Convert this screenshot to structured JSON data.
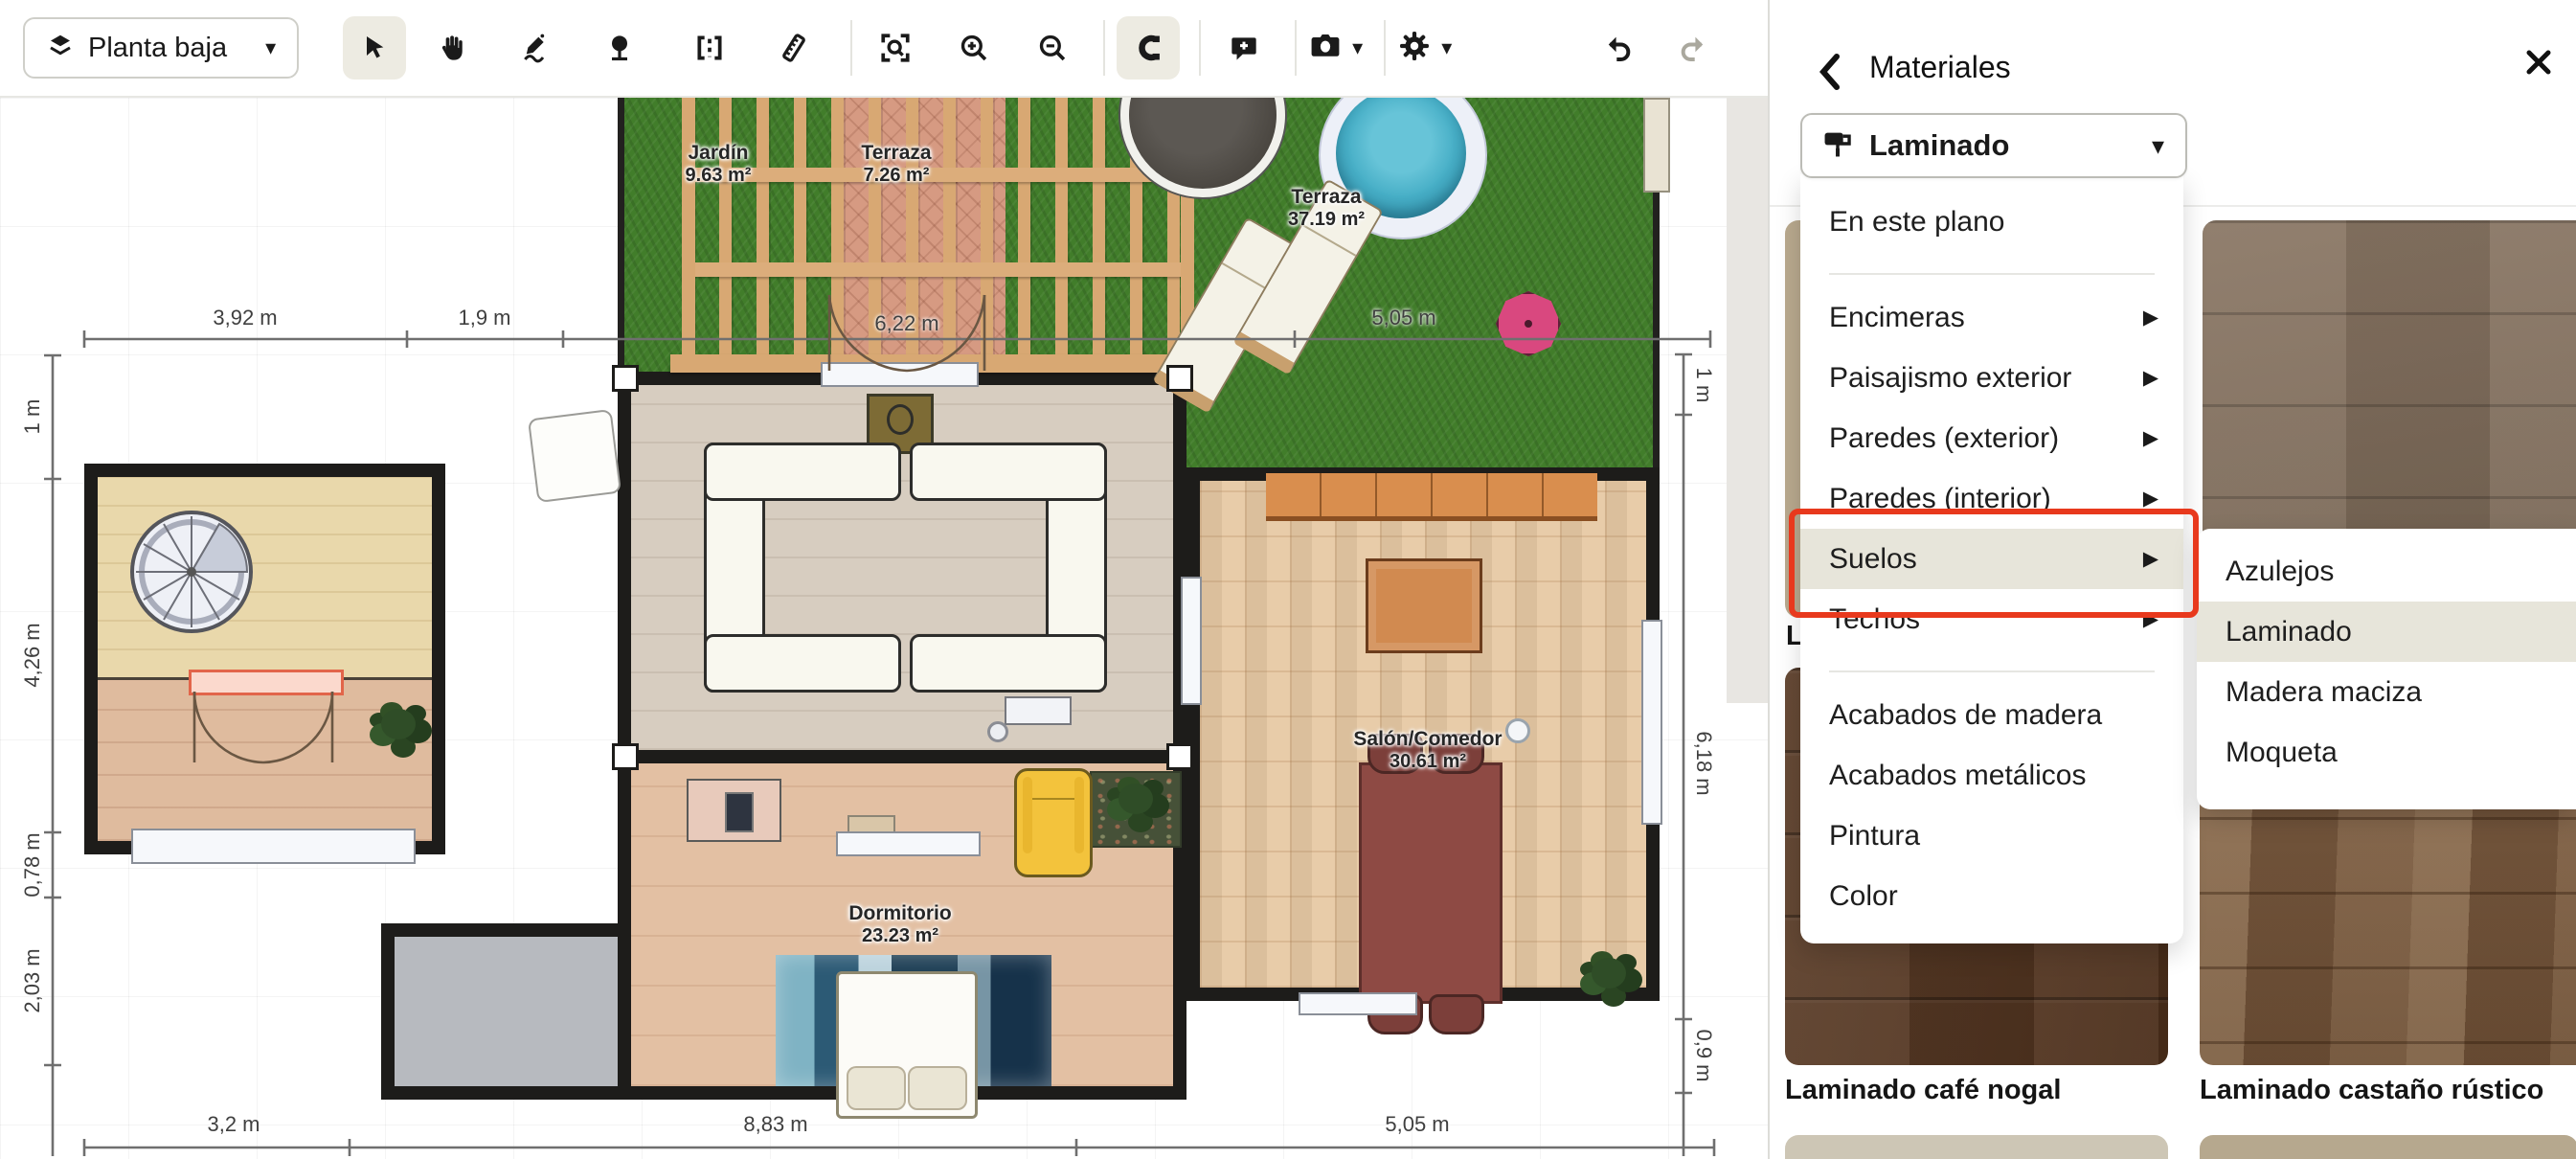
{
  "toolbar": {
    "floor_selector": "Planta baja",
    "icons": [
      "layers-icon",
      "select-tool-icon",
      "pan-hand-icon",
      "draw-pencil-icon",
      "plant-tool-icon",
      "wall-tool-icon",
      "ruler-icon",
      "zoom-fit-icon",
      "zoom-in-icon",
      "zoom-out-icon",
      "magnet-snap-icon",
      "add-note-icon",
      "camera-icon",
      "gear-icon",
      "undo-icon",
      "redo-icon"
    ]
  },
  "panel": {
    "title": "Materiales",
    "selector_label": "Laminado",
    "menu_items": {
      "this_plan": "En este plano",
      "countertops": "Encimeras",
      "landscaping": "Paisajismo exterior",
      "walls_ext": "Paredes (exterior)",
      "walls_int": "Paredes (interior)",
      "floors": "Suelos",
      "ceilings": "Techos",
      "wood_finishes": "Acabados de madera",
      "metal_finishes": "Acabados metálicos",
      "paint": "Pintura",
      "color": "Color"
    },
    "submenu_items": {
      "tiles": "Azulejos",
      "laminate": "Laminado",
      "solid_wood": "Madera maciza",
      "carpet": "Moqueta"
    },
    "swatches": {
      "cafe_nogal": "Laminado café nogal",
      "castano_rustico": "Laminado castaño rústico",
      "partial_label": "L"
    }
  },
  "plan": {
    "rooms": {
      "jardin": {
        "name": "Jardín",
        "area": "9.63 m²"
      },
      "terraza_pergola": {
        "name": "Terraza",
        "area": "7.26 m²"
      },
      "terraza": {
        "name": "Terraza",
        "area": "37.19 m²"
      },
      "salon": {
        "name": "Salón/Comedor",
        "area": "30.61 m²"
      },
      "dormitorio": {
        "name": "Dormitorio",
        "area": "23.23 m²"
      }
    },
    "dimensions": {
      "top_1": "3,92 m",
      "top_2": "1,9 m",
      "top_3": "5,05 m",
      "door": "6,22 m",
      "left_1": "1 m",
      "left_2": "4,26 m",
      "left_3": "0,78 m",
      "left_4": "2,03 m",
      "right_1": "1 m",
      "right_2": "6,18 m",
      "right_3": "0,9 m",
      "bottom_1": "3,2 m",
      "bottom_2": "8,83 m",
      "bottom_3": "5,05 m"
    }
  },
  "colors": {
    "annotation_red": "#e8391d",
    "active_tool_bg": "#edebe2",
    "highlight_row": "#e7e5da",
    "grass_green": "#417d2a",
    "umbrella_pink": "#d9487f",
    "hot_tub_teal": "#46aec6"
  }
}
